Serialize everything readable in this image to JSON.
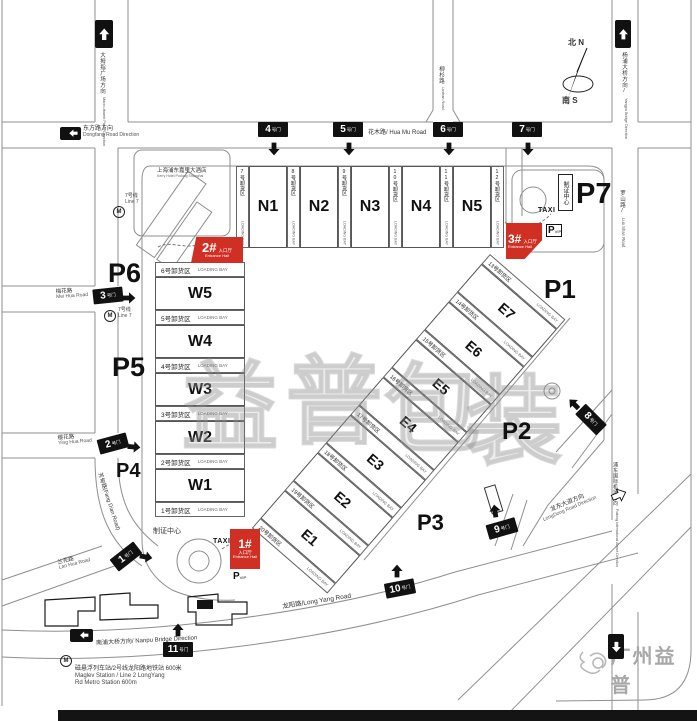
{
  "map": {
    "compass": {
      "north": "北 N",
      "south": "南 S"
    },
    "watermark": {
      "chars": [
        "益",
        "普",
        "包",
        "装"
      ],
      "logo_text": "广州益普"
    },
    "halls": {
      "north": [
        "N1",
        "N2",
        "N3",
        "N4",
        "N5"
      ],
      "west": [
        "W5",
        "W4",
        "W3",
        "W2",
        "W1"
      ],
      "east": [
        "E7",
        "E6",
        "E5",
        "E4",
        "E3",
        "E2",
        "E1"
      ]
    },
    "loading_bay_en": "LOADING BAY",
    "loading_bays": {
      "north": [
        "7号卸货区",
        "8号卸货区",
        "9号卸货区",
        "10号卸货区",
        "11号卸货区",
        "12号卸货区"
      ],
      "west": [
        "6号卸货区",
        "5号卸货区",
        "4号卸货区",
        "3号卸货区",
        "2号卸货区",
        "1号卸货区"
      ],
      "east": [
        "13号卸货区",
        "14号卸货区",
        "15号卸货区",
        "16号卸货区",
        "17号卸货区",
        "18号卸货区",
        "19号卸货区",
        "20号卸货区"
      ]
    },
    "gates": {
      "numbers": [
        "1",
        "2",
        "3",
        "4",
        "5",
        "6",
        "7",
        "8",
        "9",
        "10",
        "11"
      ],
      "suffix": "号门"
    },
    "parking": [
      "P1",
      "P2",
      "P3",
      "P4",
      "P5",
      "P6",
      "P7"
    ],
    "entrances": {
      "numbers": [
        "1#",
        "2#",
        "3#"
      ],
      "cn": "入口厅",
      "en": "Entrance Hall"
    },
    "facilities": {
      "taxi": "TAXI",
      "vip_p": "P",
      "vip": "VIP",
      "cert_center": "制证中心",
      "hotel_cn": "上海浦东嘉里大酒店",
      "hotel_en": "Kerry Hotel Pudong Shanghai"
    },
    "transit": {
      "line7_cn": "7号线",
      "line7_en": "Line 7",
      "metro_m": "M",
      "maglev_cn": "磁悬浮列车站/2号线龙阳路地铁站  600米",
      "maglev_en1": "Maglev Station / Line 2 LongYang",
      "maglev_en2": "Rd Metro Station 600m"
    },
    "roads": {
      "huamu": "花木路/ Hua Mu Road",
      "longyang": "龙阳路/Long Yang Road",
      "luoshan_cn": "罗山路/",
      "luoshan_en": "Luo Shan Road",
      "lushan_cn": "柳杉路",
      "lushan_en": "Lushan Road",
      "meihua_cn": "梅花路",
      "meihua_en": "Mei Hua Road",
      "yinghua_cn": "樱花路",
      "yinghua_en": "Ying Hua Road",
      "fangdian": "芳甸路(Fang Dian Road)",
      "lanhua_cn": "兰花路",
      "lanhua_en": "Lan Hua Road"
    },
    "directions": {
      "thumb_cn": "大拇指广场方向",
      "thumb_en": "Macro-thumb Plaza Direction",
      "dongfang_cn": "东方路方向",
      "dongfang_en": "Dongfang Road Direction",
      "yangpu_cn": "杨浦大桥方向/",
      "yangpu_en": "Yangpu Bridge Direction",
      "nanpu": "南浦大桥方向/ Nanpu Bridge Direction",
      "longdong_cn": "龙东大道方向",
      "longdong_en": "LongDong Road Direction",
      "airport_cn": "浦东国际机场方向",
      "airport_en": "Pudong International Airport Direction"
    },
    "colors": {
      "accent_red": "#d03024",
      "line_gray": "#8a8a8a",
      "gate_black": "#111111"
    }
  }
}
